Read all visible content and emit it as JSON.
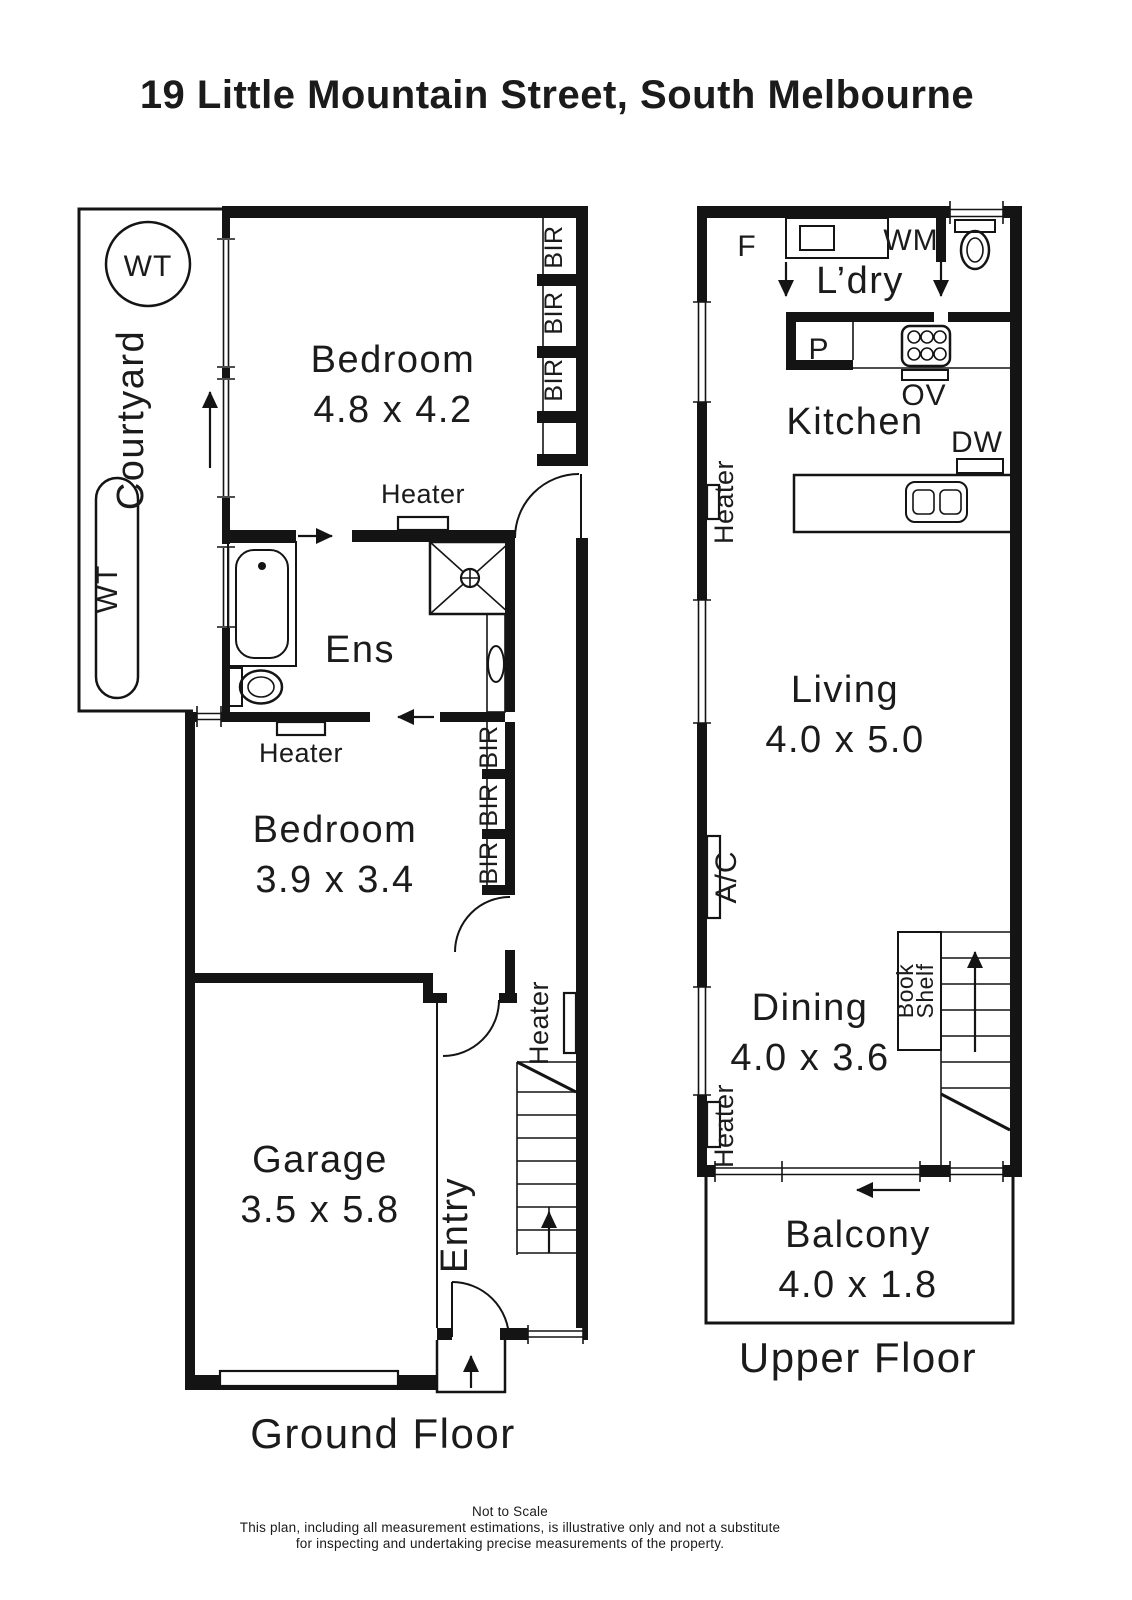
{
  "title": "19 Little Mountain Street, South Melbourne",
  "ground_floor": {
    "label": "Ground Floor",
    "courtyard": "Courtyard",
    "water_tank": "WT",
    "bedroom1": {
      "name": "Bedroom",
      "dims": "4.8 x 4.2"
    },
    "ensuite": "Ens",
    "bedroom2": {
      "name": "Bedroom",
      "dims": "3.9 x 3.4"
    },
    "garage": {
      "name": "Garage",
      "dims": "3.5 x 5.8"
    },
    "entry": "Entry",
    "bir": "BIR",
    "heater": "Heater"
  },
  "upper_floor": {
    "label": "Upper Floor",
    "laundry": "L’dry",
    "fridge": "F",
    "washing_machine": "WM",
    "pantry": "P",
    "oven": "OV",
    "kitchen": "Kitchen",
    "dishwasher": "DW",
    "living": {
      "name": "Living",
      "dims": "4.0 x 5.0"
    },
    "aircon": "A/C",
    "dining": {
      "name": "Dining",
      "dims": "4.0 x 3.6"
    },
    "bookshelf": {
      "line1": "Book",
      "line2": "Shelf"
    },
    "heater": "Heater",
    "balcony": {
      "name": "Balcony",
      "dims": "4.0 x 1.8"
    }
  },
  "footer": {
    "line1": "Not to Scale",
    "line2": "This plan, including all measurement estimations, is illustrative only and not a substitute",
    "line3": "for inspecting and undertaking precise measurements of the property."
  }
}
